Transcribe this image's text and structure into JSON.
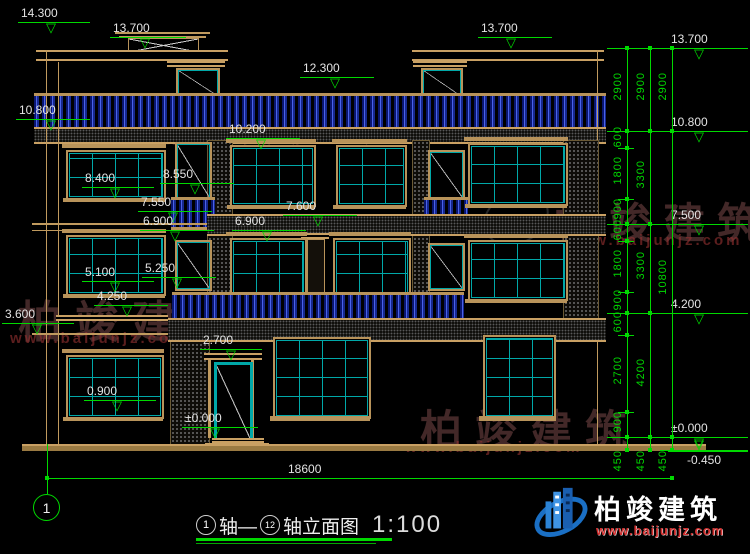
{
  "watermark": {
    "text": "柏竣建筑",
    "url": "www.baijunjz.com"
  },
  "logo": {
    "text": "柏竣建筑",
    "url": "www.baijunjz.com"
  },
  "markers": [
    "14.300",
    "13.700",
    "10.800",
    "12.300",
    "13.700",
    "13.700",
    "10.800",
    "10.200",
    "8.400",
    "8.550",
    "7.550",
    "6.900",
    "7.600",
    "6.900",
    "5.100",
    "5.250",
    "4.250",
    "3.600",
    "2.700",
    "0.900",
    "±0.000",
    "7.500",
    "4.200",
    "±0.000",
    "-0.450"
  ],
  "dims": {
    "col1": [
      "2900",
      "600",
      "1800",
      "900",
      "600",
      "1800",
      "900",
      "600",
      "2700",
      "900",
      "450"
    ],
    "col2": [
      "2900",
      "3300",
      "3300",
      "4200",
      "450"
    ],
    "col3": [
      "2900",
      "10800",
      "450"
    ],
    "overall_width": "18600"
  },
  "axis": {
    "start_bubble": "1"
  },
  "title": {
    "axis_start": "1",
    "connector": "轴—",
    "axis_end": "12",
    "name": "轴立面图",
    "scale": "1:100"
  },
  "colors": {
    "dimension_green": "#00d900",
    "outline_tan": "#c09a5e",
    "window_cyan": "#00a8a8",
    "baluster_blue": "#4a62e8",
    "logo_blue": "#1a6fc4",
    "logo_red": "#d32f2f"
  }
}
